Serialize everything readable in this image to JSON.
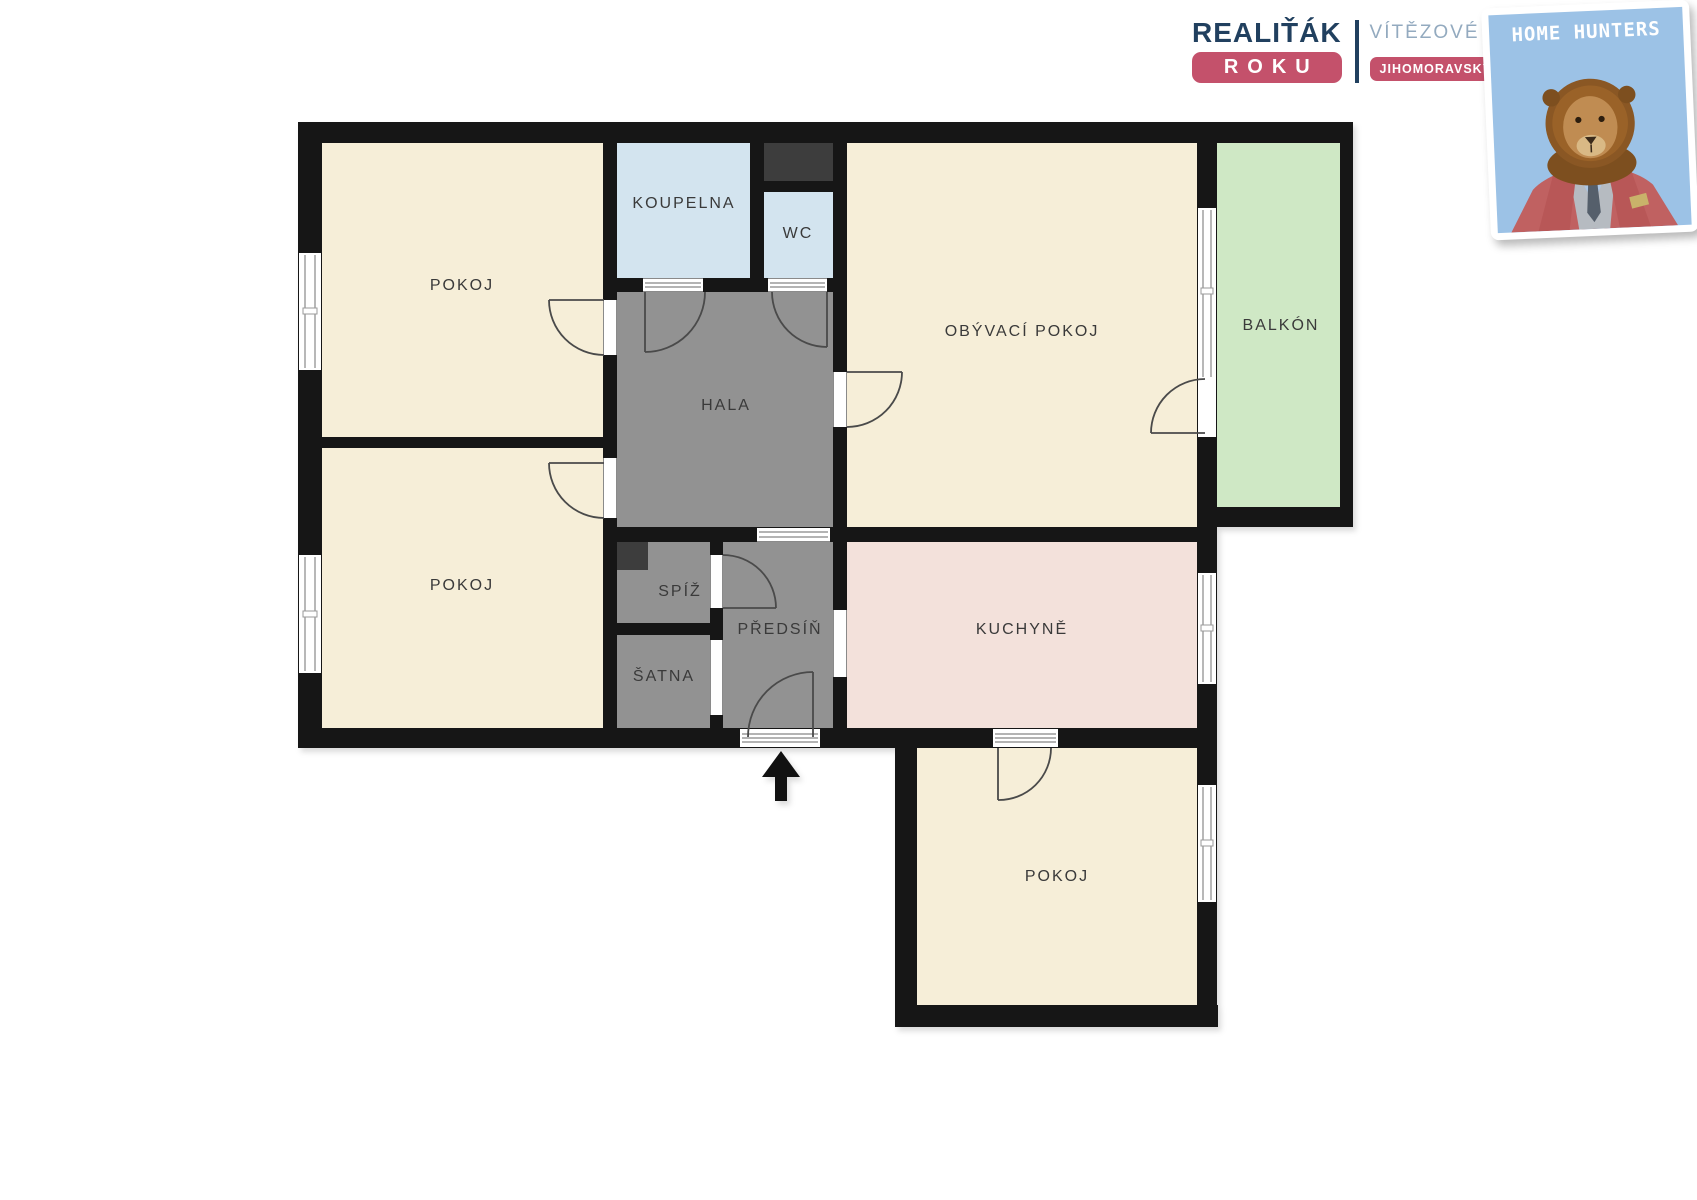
{
  "plan": {
    "rooms": {
      "pokoj_top_left": "POKOJ",
      "pokoj_bottom_left": "POKOJ",
      "koupelna": "KOUPELNA",
      "wc": "WC",
      "obyvaci_pokoj": "OBÝVACÍ POKOJ",
      "balkon": "BALKÓN",
      "hala": "HALA",
      "spiz": "SPÍŽ",
      "predsin": "PŘEDSÍŇ",
      "satna": "ŠATNA",
      "kuchyne": "KUCHYNĚ",
      "pokoj_bottom": "POKOJ"
    },
    "colors": {
      "room": "#f6eed8",
      "bathroom": "#d3e4ef",
      "balcony": "#cfe8c5",
      "hallway": "#929292",
      "shaft": "#3d3d3d",
      "kitchen": "#f3e1db"
    }
  },
  "branding": {
    "realitak": {
      "title": "REALIŤÁK",
      "subtitle": "ROKU",
      "tagline_top": "VÍTĚZOVÉ PRO",
      "tagline_bottom": "JIHOMORAVSKÝ KRAJ"
    },
    "home_hunters": {
      "logo_text": "HOME HUNTERS"
    }
  },
  "theme": {
    "--wall": "#161616",
    "--label": "#3a3a3a",
    "--door": "#4a4a4a",
    "--win-frame": "#9a9a9a",
    "--navy": "#21405f",
    "--brand-red": "#c4516b",
    "--steel": "#93aabf",
    "--hh-blue": "#9cc2e6"
  }
}
